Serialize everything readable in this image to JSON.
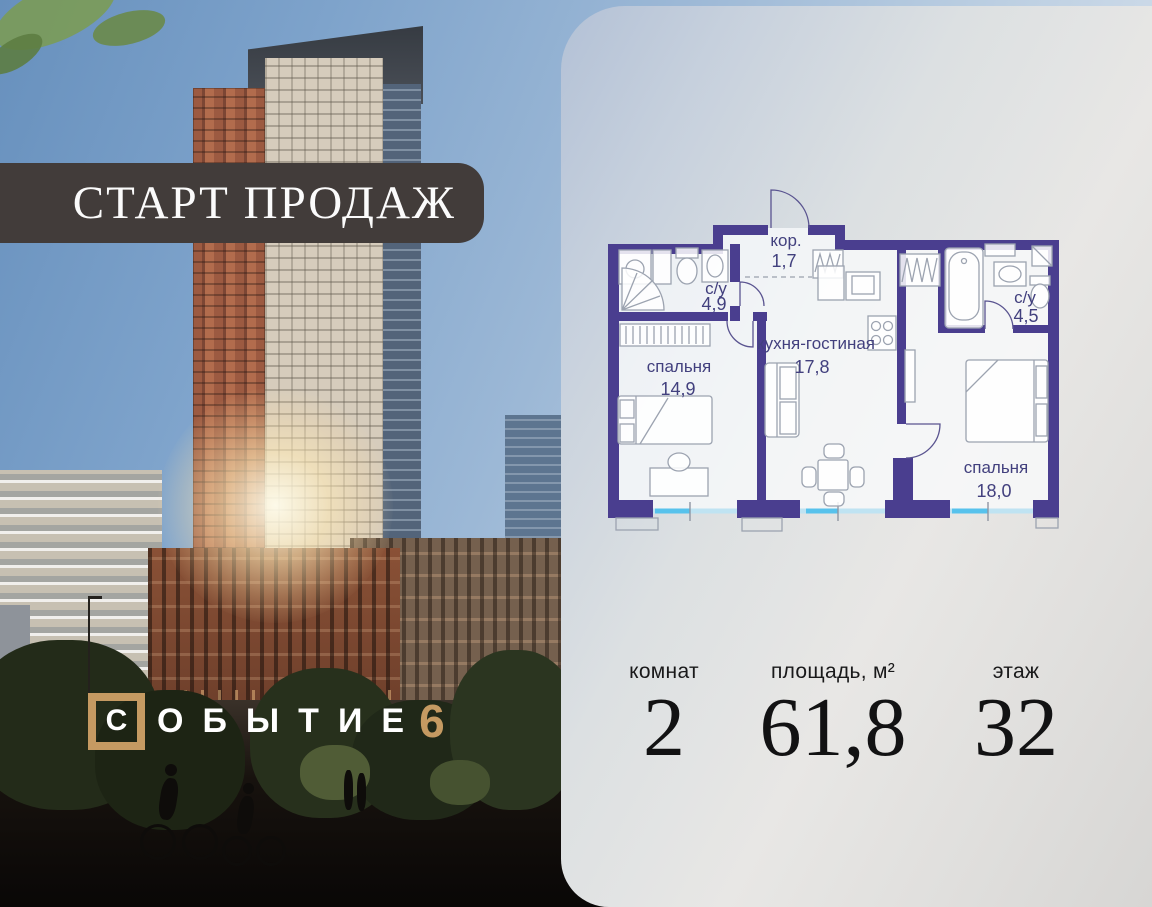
{
  "banner": {
    "text": "СТАРТ ПРОДАЖ"
  },
  "logo": {
    "boxed_letter": "С",
    "word_rest": "ОБЫТИЕ",
    "number": "6"
  },
  "plan": {
    "rooms": [
      {
        "name": "кор.",
        "area": "1,7"
      },
      {
        "name": "с/у",
        "area": "4,9"
      },
      {
        "name": "спальня",
        "area": "14,9"
      },
      {
        "name": "кухня-гостиная",
        "area": "17,8"
      },
      {
        "name": "с/у",
        "area": "4,5"
      },
      {
        "name": "спальня",
        "area": "18,0"
      }
    ]
  },
  "stats": {
    "rooms": {
      "label": "комнат",
      "value": "2"
    },
    "area": {
      "label": "площадь, м²",
      "value": "61,8"
    },
    "floor": {
      "label": "этаж",
      "value": "32"
    }
  },
  "colors": {
    "accent_tan": "#C59A62",
    "banner_bg": "#423C3A",
    "plan_wall": "#4A3E8F",
    "window_blue": "#57C2EC"
  }
}
